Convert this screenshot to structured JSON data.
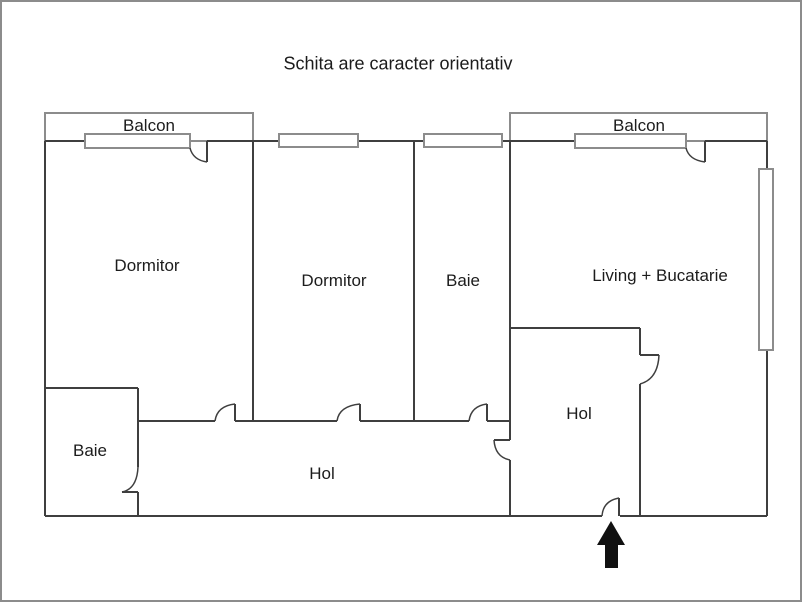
{
  "title": "Schita are caracter orientativ",
  "colors": {
    "background": "#ffffff",
    "frame": "#8c8c8c",
    "wall": "#3f3f3f",
    "light_line": "#8c8c8c",
    "text": "#1c1c1c",
    "arrow": "#111111"
  },
  "rooms": [
    {
      "id": "balcon-left",
      "label": "Balcon",
      "x": 147,
      "y": 124
    },
    {
      "id": "balcon-right",
      "label": "Balcon",
      "x": 637,
      "y": 124
    },
    {
      "id": "dormitor-1",
      "label": "Dormitor",
      "x": 145,
      "y": 264
    },
    {
      "id": "dormitor-2",
      "label": "Dormitor",
      "x": 332,
      "y": 279
    },
    {
      "id": "baie-top",
      "label": "Baie",
      "x": 461,
      "y": 279
    },
    {
      "id": "living-bucatarie",
      "label": "Living + Bucatarie",
      "x": 658,
      "y": 274
    },
    {
      "id": "baie-bottom",
      "label": "Baie",
      "x": 88,
      "y": 449
    },
    {
      "id": "hol-corridor",
      "label": "Hol",
      "x": 320,
      "y": 472
    },
    {
      "id": "hol-entrance",
      "label": "Hol",
      "x": 577,
      "y": 412
    }
  ],
  "plan": {
    "balconies": [
      [
        43,
        111,
        208,
        28
      ],
      [
        508,
        111,
        257,
        28
      ]
    ],
    "walls": [
      [
        43,
        139,
        188,
        139
      ],
      [
        205,
        139,
        684,
        139
      ],
      [
        703,
        139,
        765,
        139
      ],
      [
        43,
        139,
        43,
        514
      ],
      [
        765,
        139,
        765,
        514
      ],
      [
        43,
        514,
        600,
        514
      ],
      [
        618,
        514,
        765,
        514
      ],
      [
        251,
        139,
        251,
        419
      ],
      [
        412,
        139,
        412,
        419
      ],
      [
        508,
        139,
        508,
        438
      ],
      [
        508,
        458,
        508,
        514
      ],
      [
        508,
        326,
        638,
        326
      ],
      [
        638,
        326,
        638,
        353
      ],
      [
        638,
        382,
        638,
        514
      ],
      [
        136,
        419,
        213,
        419
      ],
      [
        233,
        419,
        335,
        419
      ],
      [
        358,
        419,
        467,
        419
      ],
      [
        485,
        419,
        508,
        419
      ],
      [
        43,
        386,
        136,
        386
      ],
      [
        136,
        386,
        136,
        465
      ],
      [
        136,
        490,
        136,
        514
      ],
      [
        120,
        490,
        136,
        490
      ],
      [
        233,
        402,
        233,
        419
      ],
      [
        358,
        402,
        358,
        419
      ],
      [
        485,
        402,
        485,
        419
      ],
      [
        205,
        139,
        205,
        160
      ],
      [
        703,
        139,
        703,
        160
      ],
      [
        617,
        496,
        617,
        514
      ],
      [
        492,
        438,
        508,
        438
      ],
      [
        638,
        353,
        657,
        353
      ]
    ],
    "windows": [
      [
        83,
        132,
        105,
        14
      ],
      [
        277,
        132,
        79,
        13
      ],
      [
        422,
        132,
        78,
        13
      ],
      [
        573,
        132,
        111,
        14
      ],
      [
        757,
        167,
        14,
        181
      ]
    ],
    "door_arcs": [
      "M 188 146 Q 191 158 205 160",
      "M 684 146 Q 687 158 703 160",
      "M 213 419 Q 215 404 233 402",
      "M 335 419 Q 337 404 358 402",
      "M 467 419 Q 469 404 485 402",
      "M 492 438 Q 493 455 508 458",
      "M 657 353 Q 656 377 638 382",
      "M 136 465 Q 135 487 120 490",
      "M 600 514 Q 601 499 617 496"
    ],
    "entrance_arrow": "609,519 623,543 616,543 616,566 603,566 603,543 595,543"
  }
}
